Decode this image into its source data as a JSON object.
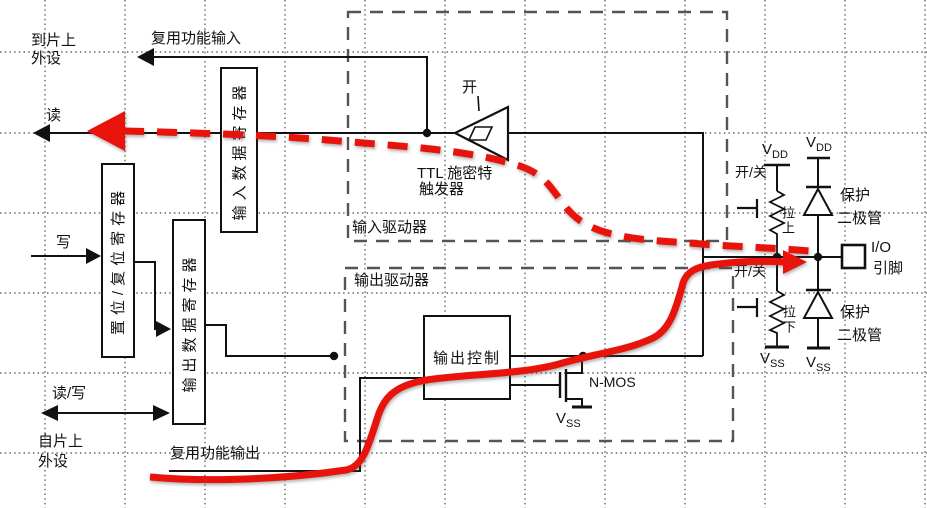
{
  "colors": {
    "line": "#111111",
    "dashed_box": "#555555",
    "grid": "#666666",
    "accent_red": "#e8140c"
  },
  "labels": {
    "to_chip_1": "到片上",
    "to_chip_2": "外设",
    "alt_func_in": "复用功能输入",
    "read": "读",
    "write": "写",
    "read_write": "读/写",
    "from_chip_1": "自片上",
    "from_chip_2": "外设",
    "alt_func_out": "复用功能输出",
    "input_data_reg": "输入数据寄存器",
    "set_reset_reg": "置位/复位寄存器",
    "output_data_reg": "输出数据寄存器",
    "input_driver": "输入驱动器",
    "output_driver": "输出驱动器",
    "on": "开",
    "on_off": "开/关",
    "schmitt_1": "TTL 施密特",
    "schmitt_2": "触发器",
    "output_control": "输出控制",
    "nmos": "N-MOS",
    "pull_up": "拉上",
    "pull_down": "拉下",
    "protect_1": "保护",
    "protect_2": "二极管",
    "io_1": "I/O",
    "io_2": "引脚",
    "v": "V",
    "dd": "DD",
    "ss": "SS"
  }
}
